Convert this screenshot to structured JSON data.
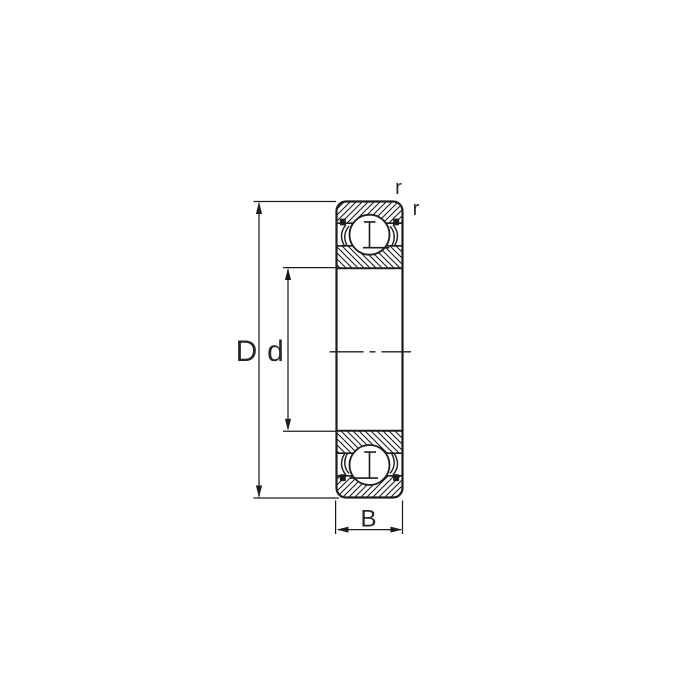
{
  "drawing": {
    "subject": "deep-groove ball bearing cross-section with shields",
    "dimensions": {
      "outer_diameter_label": "D",
      "bore_diameter_label": "d",
      "width_label": "B",
      "corner_radius_labels": [
        "r",
        "r"
      ]
    },
    "colors": {
      "line": "#1c1c1c",
      "label": "#262626",
      "background": "#ffffff"
    }
  }
}
